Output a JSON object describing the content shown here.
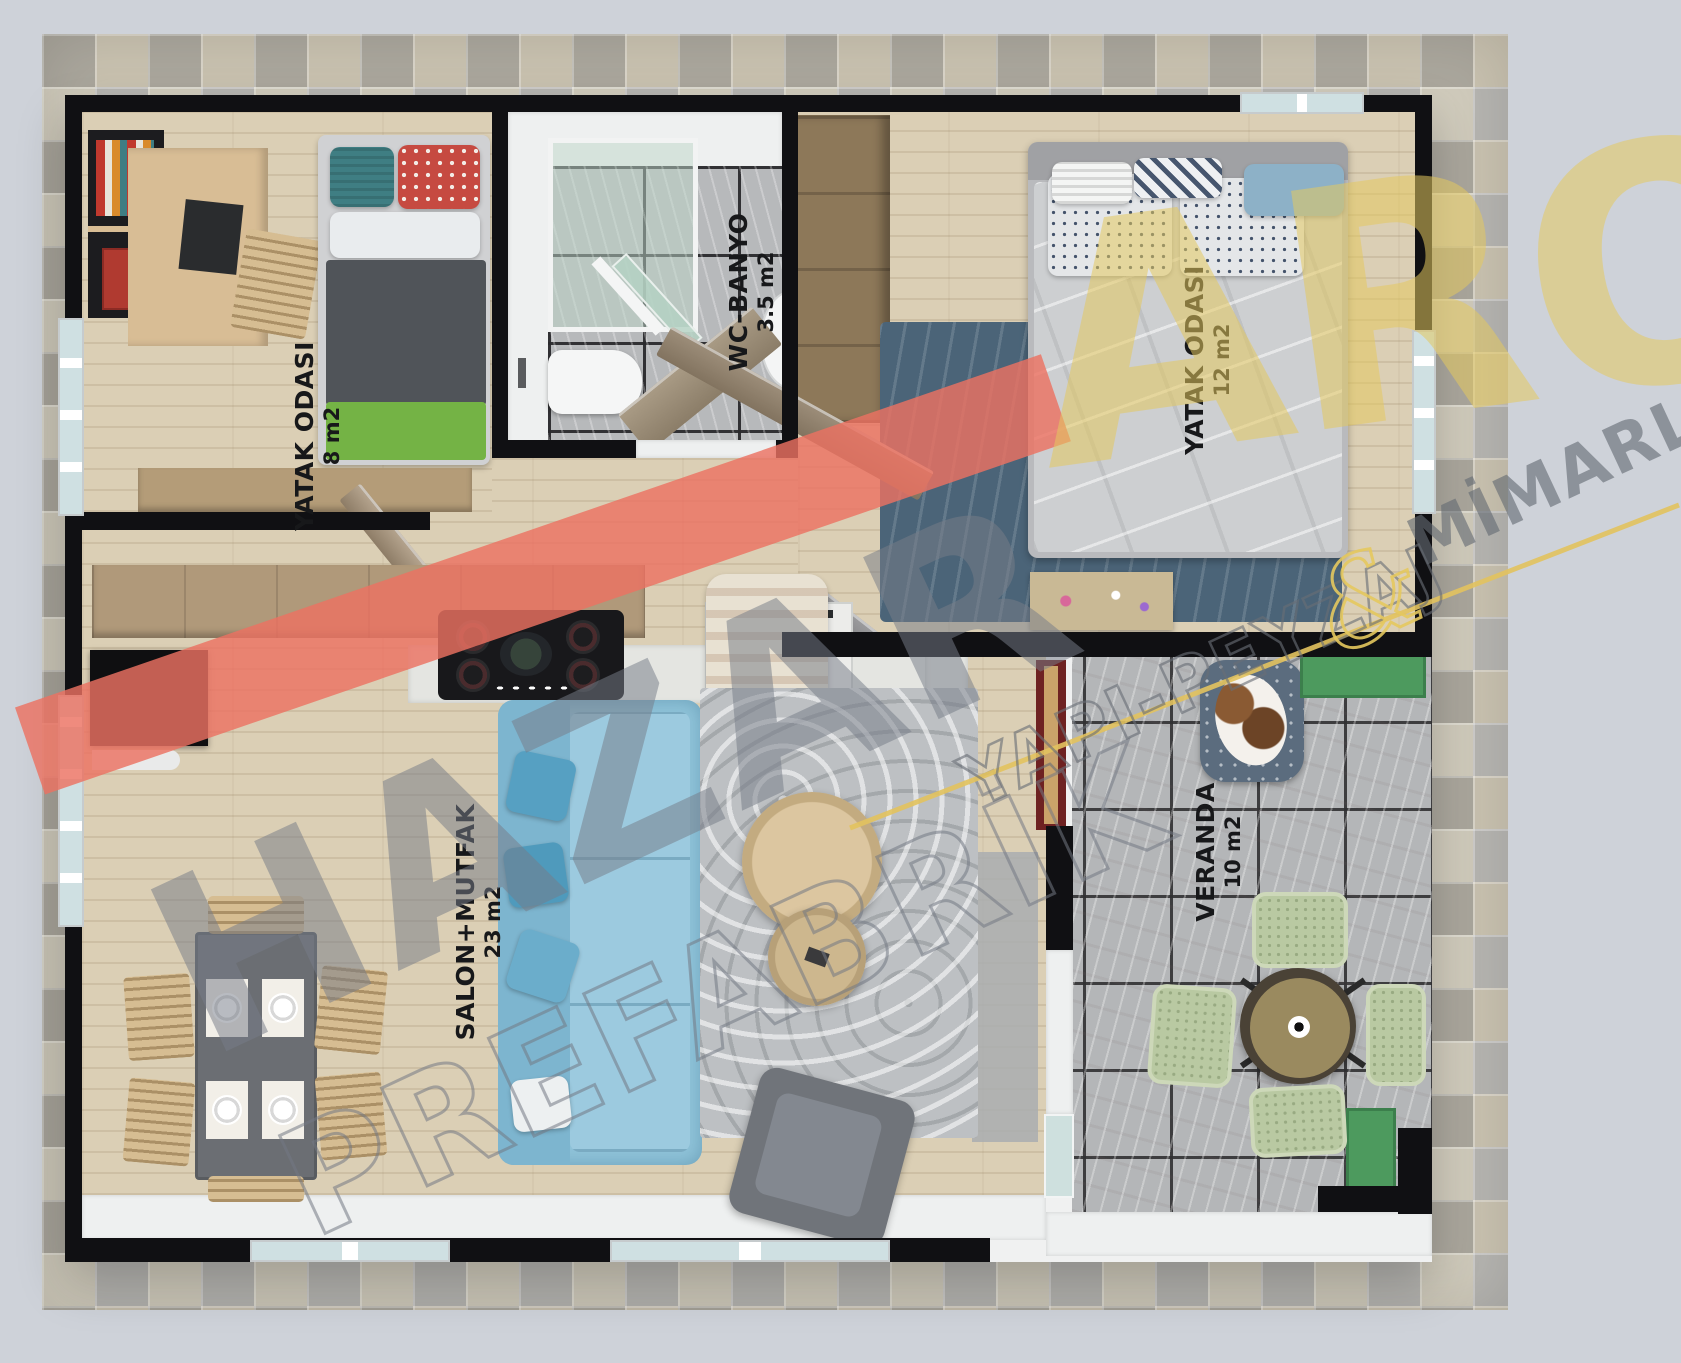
{
  "rooms": [
    {
      "name": "YATAK ODASI",
      "area": "8 m2"
    },
    {
      "name": "WC-BANYO",
      "area": "3.5 m2"
    },
    {
      "name": "YATAK ODASI",
      "area": "12 m2"
    },
    {
      "name": "SALON+MUTFAK",
      "area": "23 m2"
    },
    {
      "name": "VERANDA",
      "area": "10 m2"
    }
  ],
  "watermark": {
    "brand": "HAZAR",
    "brand_line2": "PREFABRİK",
    "logo": "ARO",
    "tagline_left": "YAPI-PEYZAJ",
    "tagline_amp": "&",
    "tagline_right": "MİMARLIK"
  },
  "colors": {
    "background": "#ced2d9",
    "wall": "#101013",
    "wood-floor": "#dbcfb5",
    "tile-floor": "#b4b6b8",
    "patio-a": "#c9c2b0",
    "patio-b": "#b6b5b1",
    "sofa": "#8fc3d9",
    "green-accent": "#74b345",
    "planter-green": "#4d9a5e",
    "watermark-band": "#ec7261",
    "watermark-yellow": "#e3c35f",
    "watermark-gray": "#6e7480",
    "label-text": "#17181a"
  }
}
